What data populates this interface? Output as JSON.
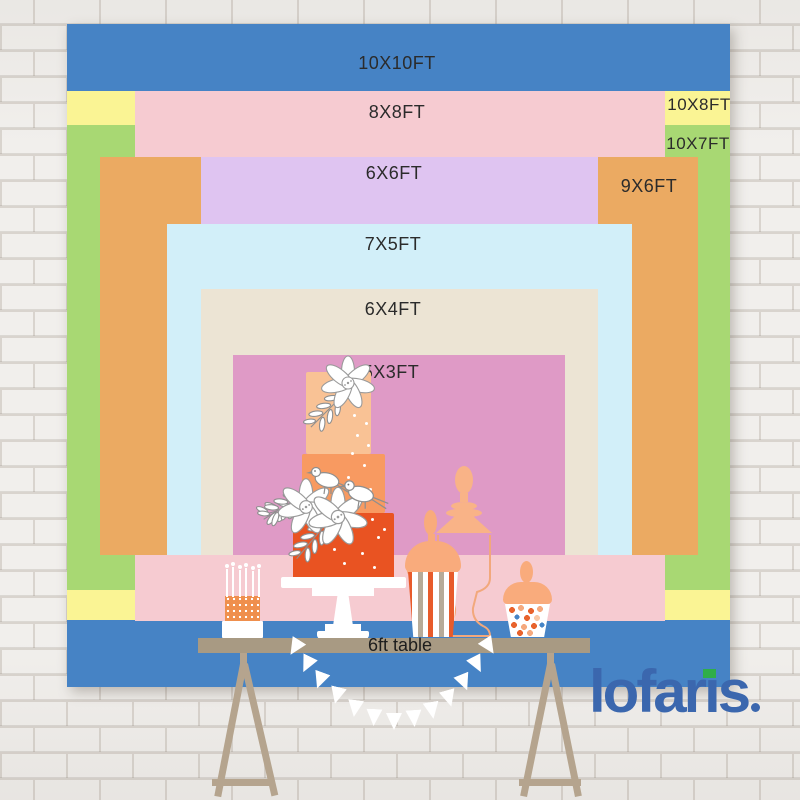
{
  "sizes": [
    {
      "label": "10X10FT",
      "width_ft": 10,
      "height_ft": 10,
      "color": "#4683c5"
    },
    {
      "label": "10X8FT",
      "width_ft": 10,
      "height_ft": 8,
      "color": "#faf494"
    },
    {
      "label": "10X7FT",
      "width_ft": 10,
      "height_ft": 7,
      "color": "#a8d873"
    },
    {
      "label": "8X8FT",
      "width_ft": 8,
      "height_ft": 8,
      "color": "#f6cbd1"
    },
    {
      "label": "9X6FT",
      "width_ft": 9,
      "height_ft": 6,
      "color": "#ebaa62"
    },
    {
      "label": "6X6FT",
      "width_ft": 6,
      "height_ft": 6,
      "color": "#dfc4f1"
    },
    {
      "label": "7X5FT",
      "width_ft": 7,
      "height_ft": 5,
      "color": "#d2eff9"
    },
    {
      "label": "6X4FT",
      "width_ft": 6,
      "height_ft": 4,
      "color": "#ece4d4"
    },
    {
      "label": "5X3FT",
      "width_ft": 5,
      "height_ft": 3,
      "color": "#df9ac6"
    }
  ],
  "table": {
    "label": "6ft table",
    "color": "#a89a83"
  },
  "brand": {
    "name": "lofaris",
    "wordmark": {
      "pre": "lofar",
      "i": "ı",
      "post": "s"
    },
    "logo_color": "#3b67ae",
    "flag_color": "#2fae49"
  },
  "palette": {
    "cake_top": "#f9c295",
    "cake_middle": "#f89a61",
    "cake_bottom": "#e95322",
    "peach": "#f9ab7c",
    "trestle": "#b5a48e",
    "stripe_red": "#e85b2b",
    "stripe_tan": "#b7ab99"
  }
}
